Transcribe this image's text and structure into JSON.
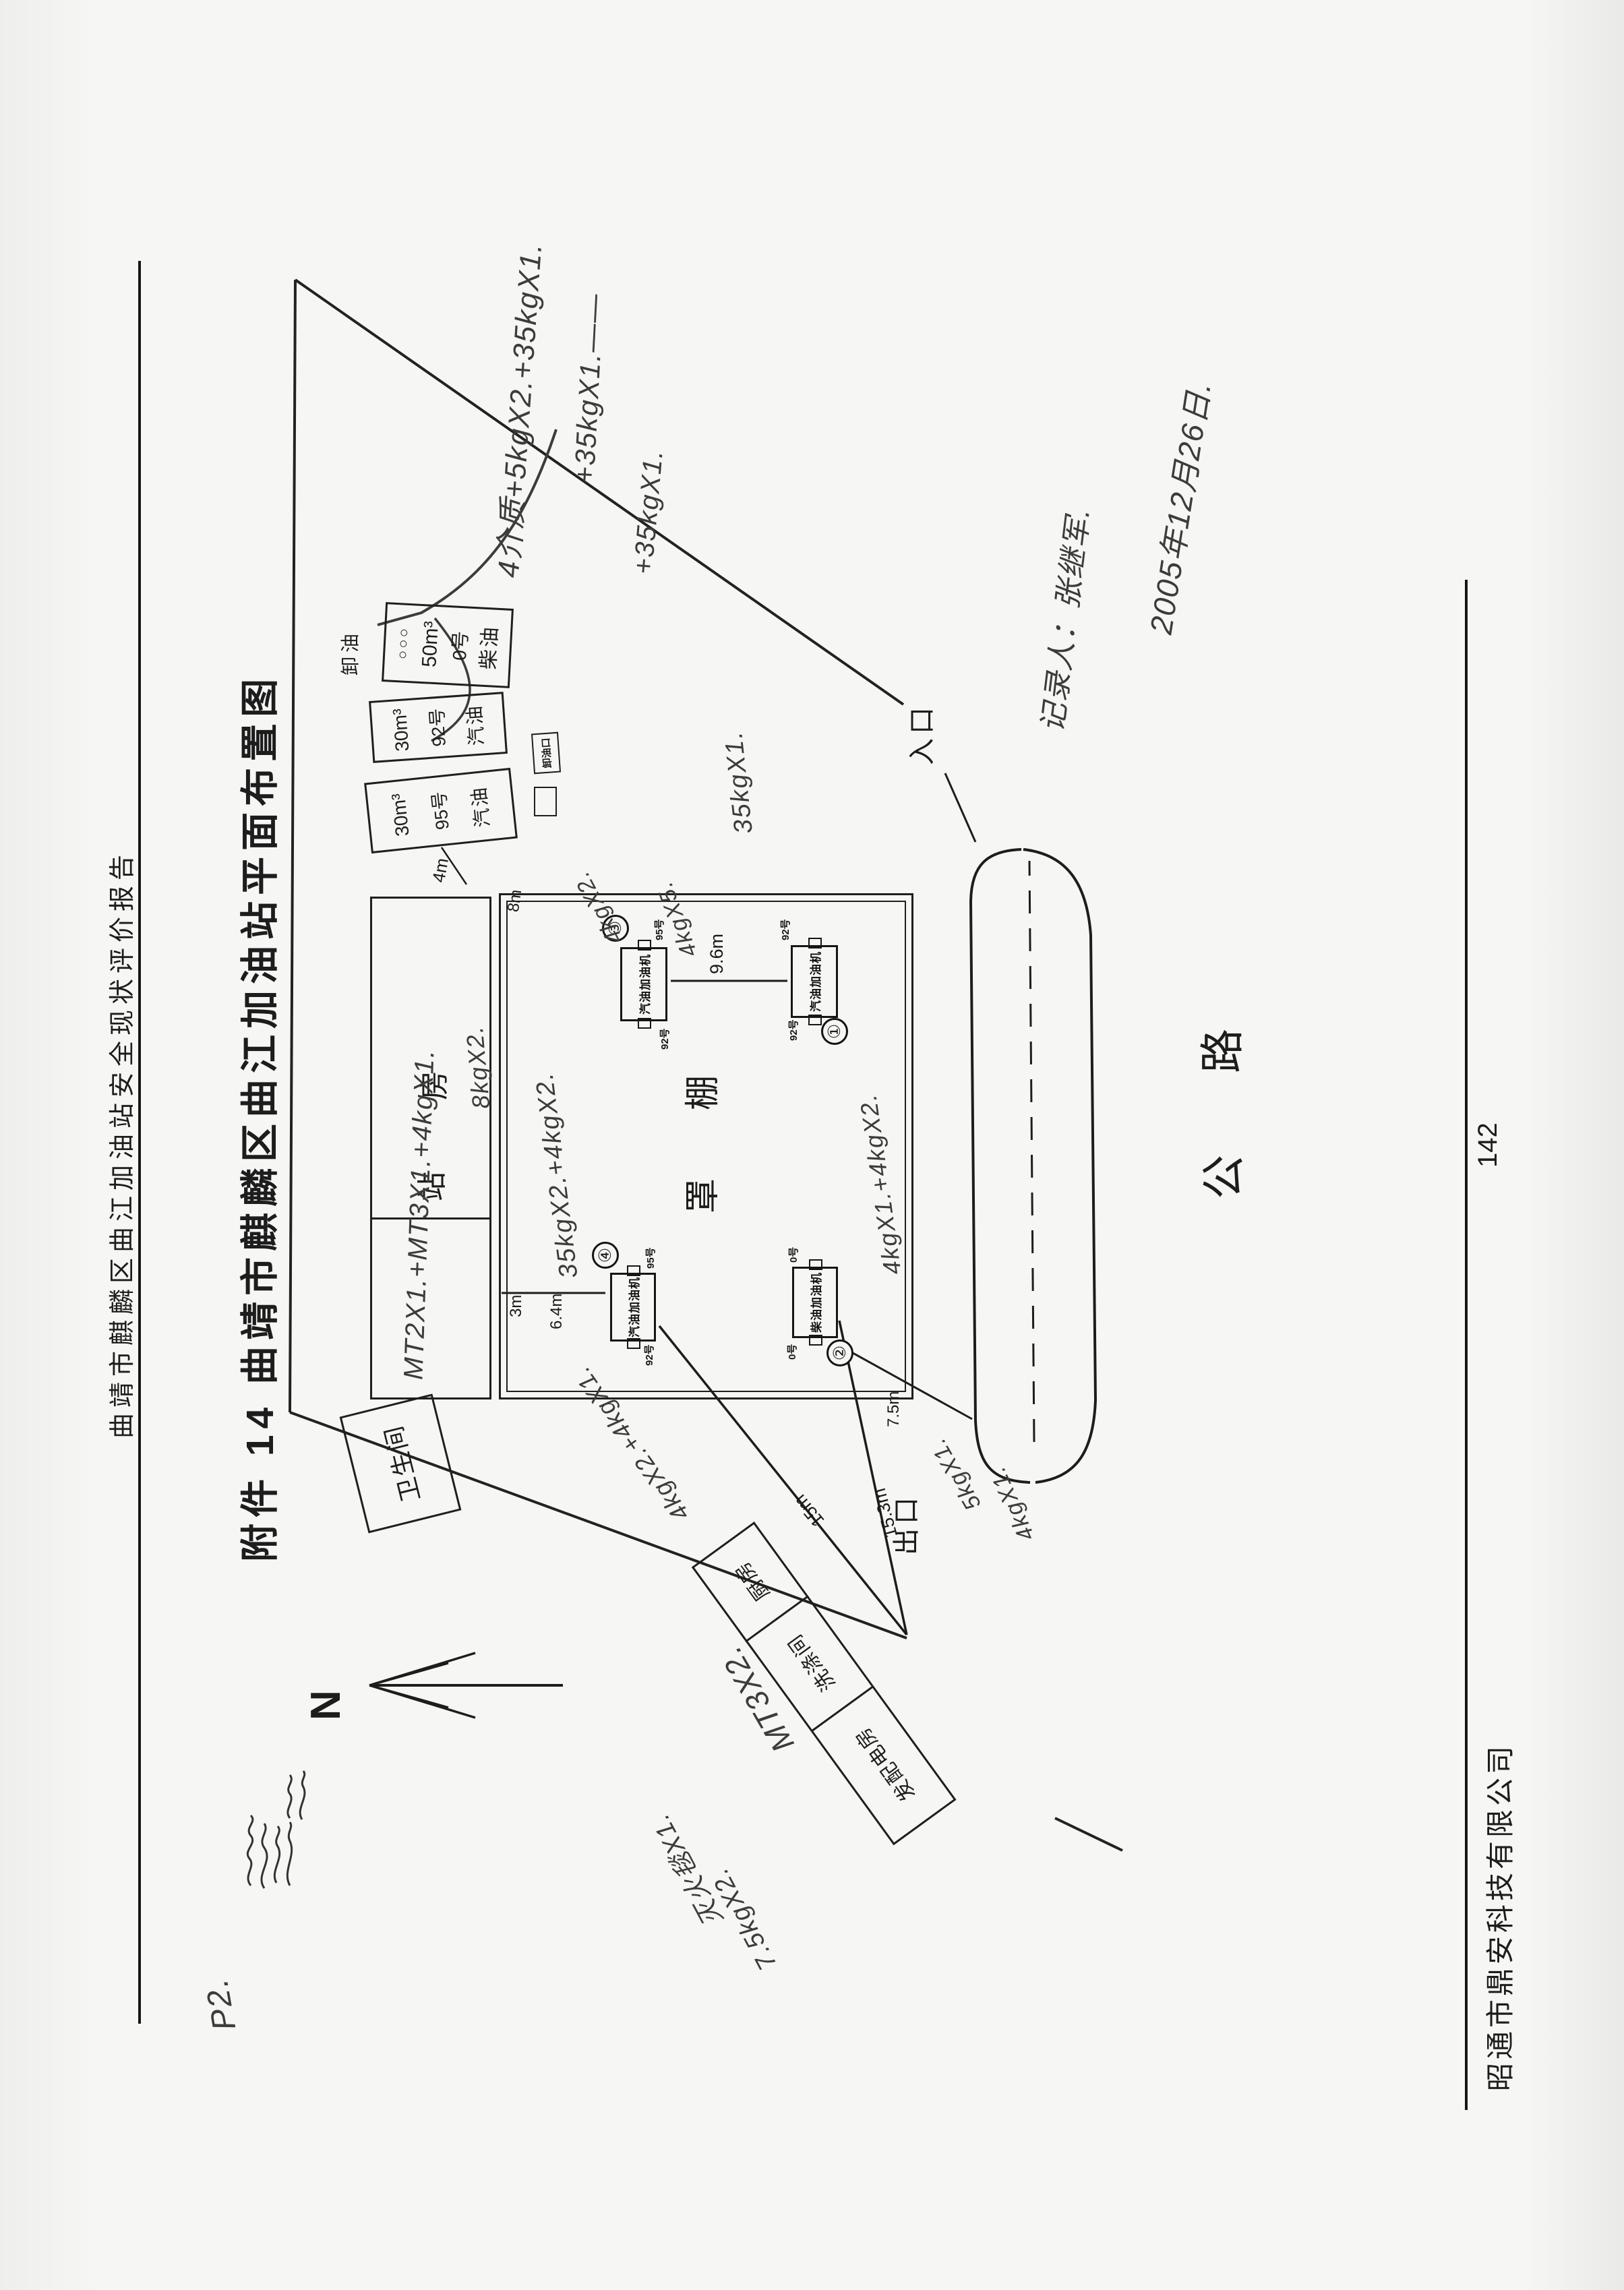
{
  "header": {
    "report_title": "曲靖市麒麟区曲江加油站安全现状评价报告"
  },
  "title": "附件 14 曲靖市麒麟区曲江加油站平面布置图",
  "footer": {
    "company": "昭通市鼎安科技有限公司",
    "page_number": "142"
  },
  "annotations": {
    "corner_mark": "P2.",
    "note_a": "4介质+5kgX2.+35kgX1.",
    "note_b": "+35kgX1.——",
    "note_c": "+35kgX1.",
    "tank_note": "35kgX1.",
    "date": "2005年12月26日.",
    "recorder": "记录人：张继军.",
    "station_note": "MT2X1.+MT3X1.+4kgX1.",
    "note_8kg": "8kgX2.",
    "canopy_note1": "35kgX2.+4kgX2.",
    "canopy_note2": "4kgX2.",
    "canopy_note3": "4kgX5.",
    "canopy_note4": "4kgX1.+4kgX2.",
    "island_note": "4kgX2.+4kgX1.",
    "power_note": "MT3X2.",
    "blanket_note": "灭火毯X1.",
    "kg75_note": "7.5kgX2.",
    "road_note1": "5kgX1.",
    "road_note2": "4kgX1."
  },
  "diagram": {
    "north": "N",
    "road_label_1": "公",
    "road_label_2": "路",
    "entrance": "入口",
    "exit": "出口",
    "canopy_label_1": "罩",
    "canopy_label_2": "棚",
    "station_label_1": "站",
    "station_label_2": "房",
    "toilet": "卫生间",
    "rooms": [
      {
        "label": "发配电房"
      },
      {
        "label": "洗涤间"
      },
      {
        "label": "厨房"
      }
    ],
    "tanks": [
      {
        "ports": "○○○",
        "volume": "50m³",
        "grade": "0号",
        "product": "柴油"
      },
      {
        "volume": "30m³",
        "grade": "92号",
        "product": "汽油"
      },
      {
        "volume": "30m³",
        "grade": "95号",
        "product": "汽油"
      }
    ],
    "tank_area_label": "卸油",
    "unload_box_label": "卸油口",
    "dispensers": [
      {
        "num": "③",
        "name": "汽油加油机",
        "end_a": "95号",
        "end_b": "92号"
      },
      {
        "num": "①",
        "name": "汽油加油机",
        "end_a": "92号",
        "end_b": "92号"
      },
      {
        "num": "④",
        "name": "汽油加油机",
        "end_a": "92号",
        "end_b": "95号"
      },
      {
        "num": "②",
        "name": "柴油加油机",
        "end_a": "0号",
        "end_b": "0号"
      }
    ],
    "dims": {
      "d4": "4m",
      "d8": "8m",
      "d96": "9.6m",
      "d3": "3m",
      "d64": "6.4m",
      "d75": "7.5m",
      "d15": "15m",
      "d153": "15.3m"
    }
  }
}
